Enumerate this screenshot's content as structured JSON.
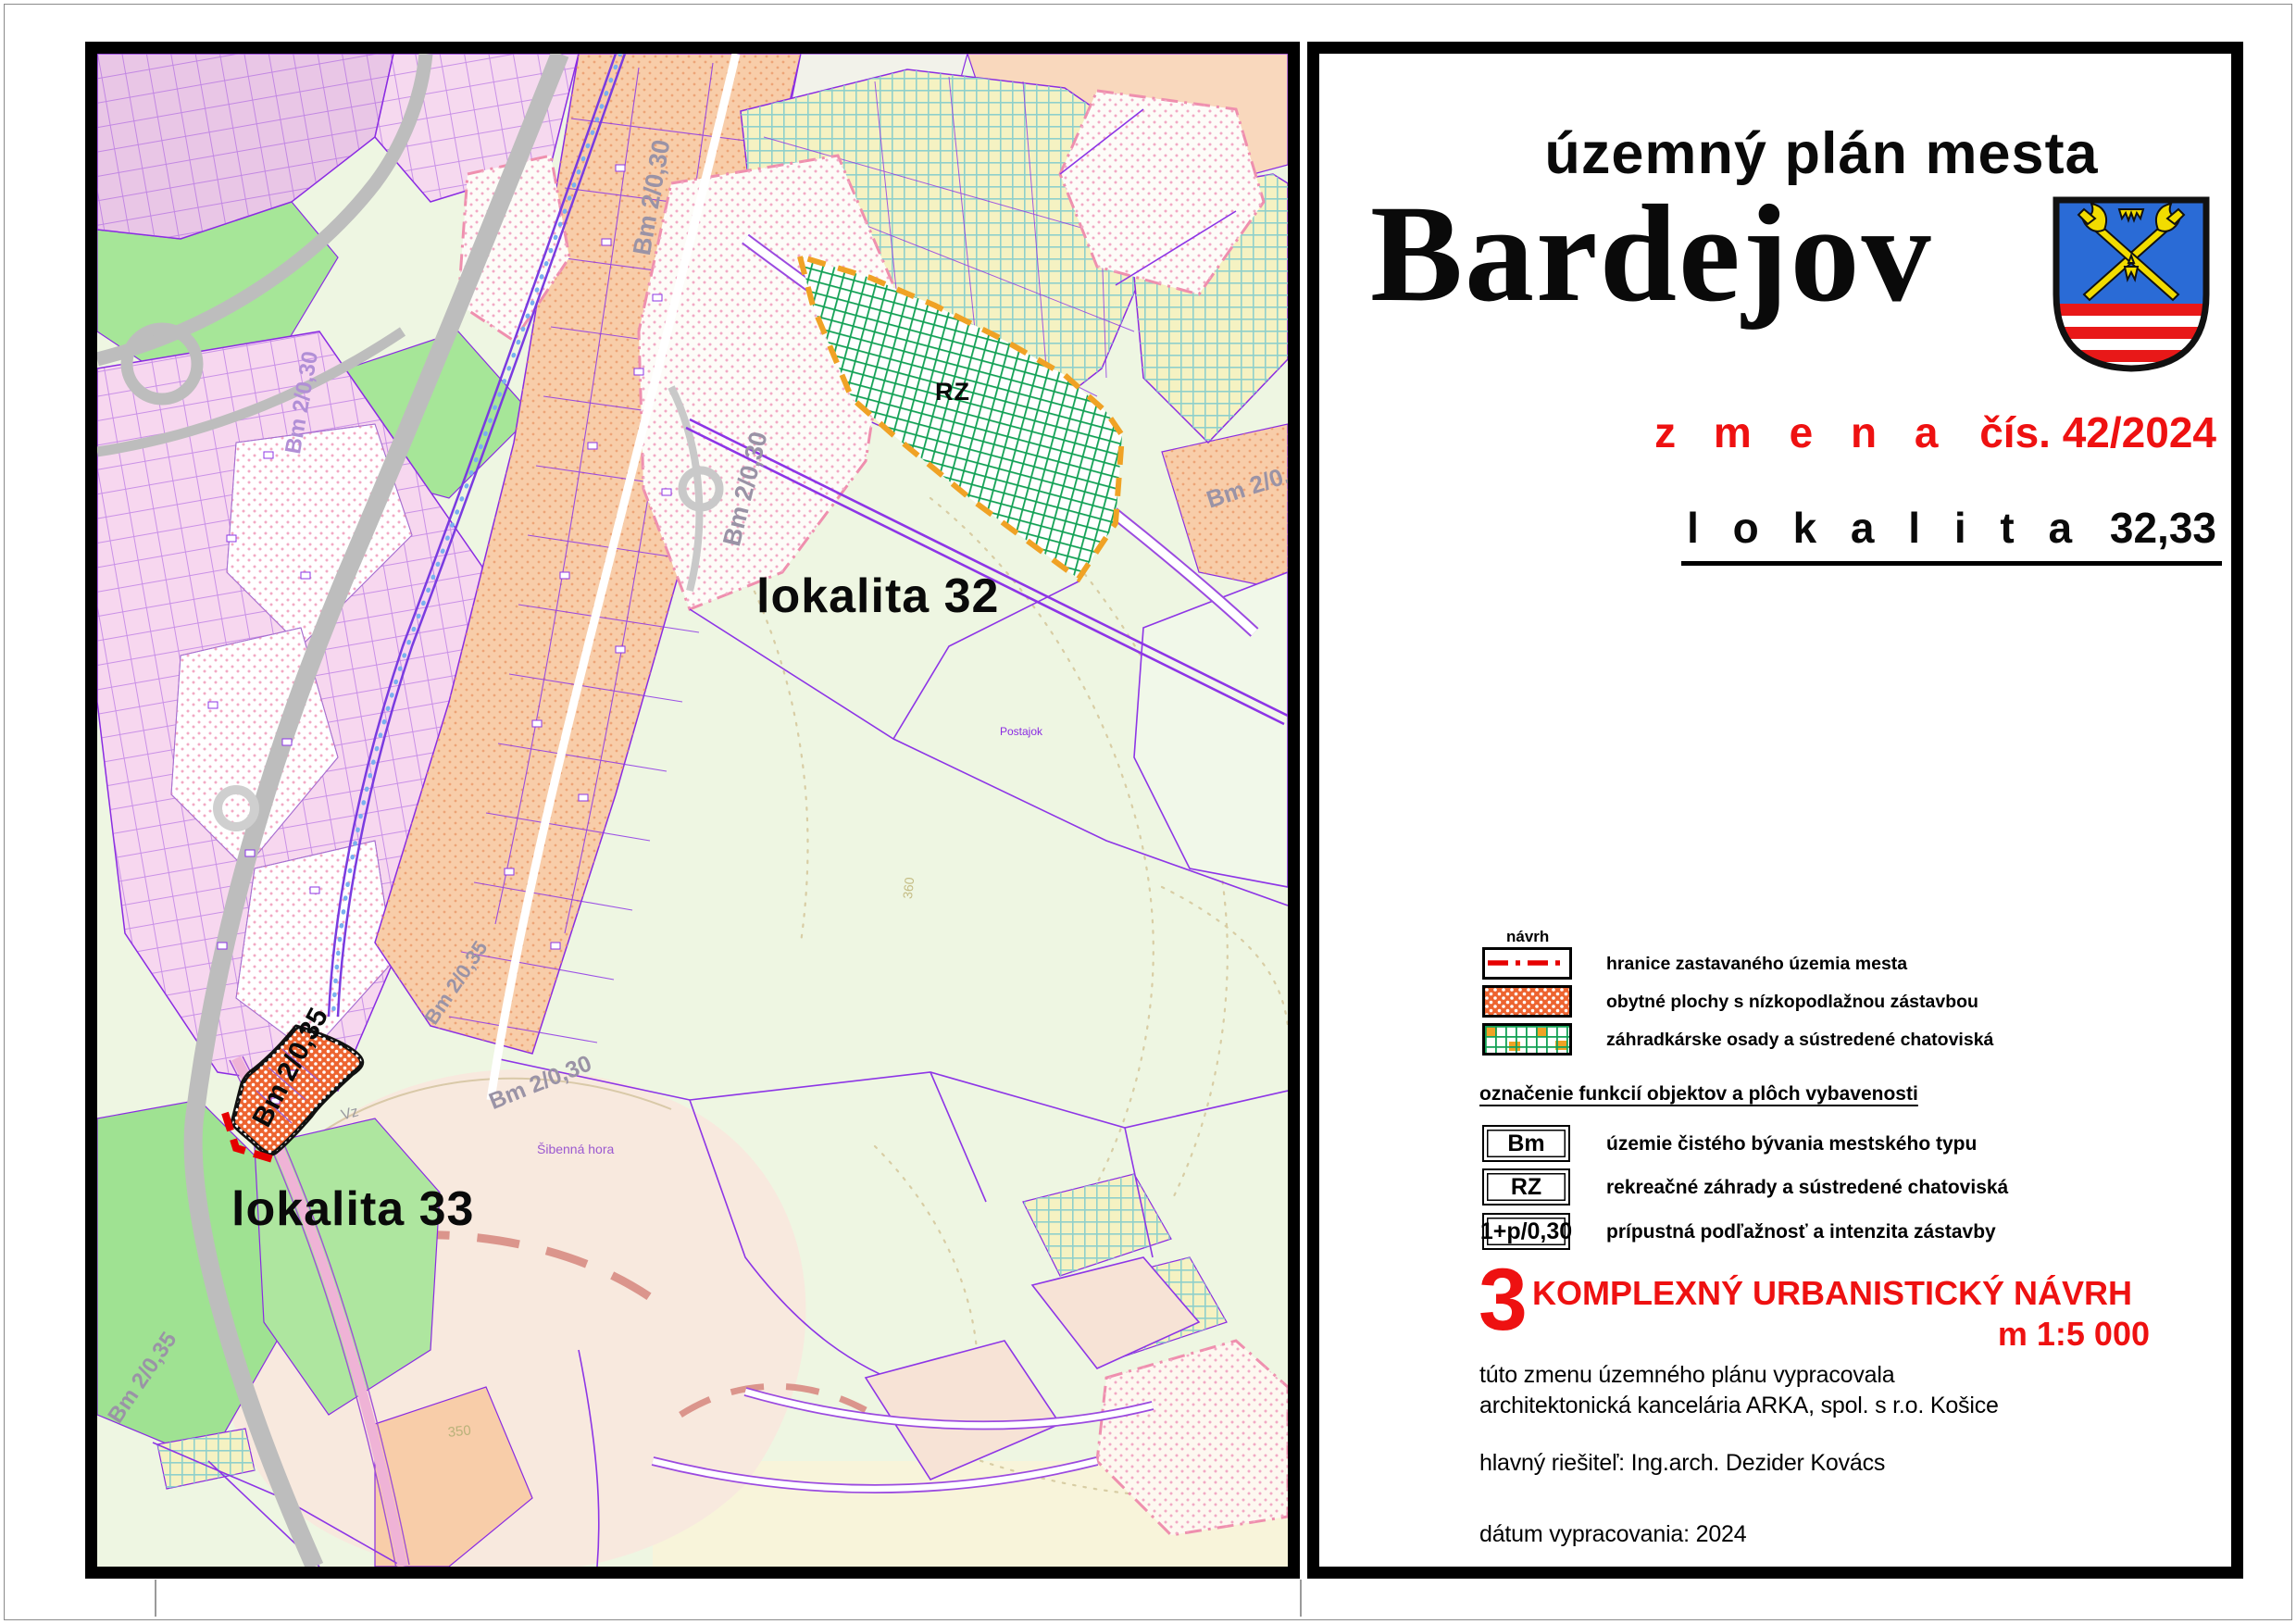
{
  "map": {
    "labels": {
      "lokalita32": "lokalita 32",
      "lokalita33": "lokalita 33",
      "rz": "RZ",
      "parcel": "Bm 2/0,35",
      "bm_g1": "Bm 2/0,30",
      "bm_g2": "Bm 2/0,30",
      "bm_g3": "Bm 2/0,30",
      "bm_g4": "Bm 2/0,30",
      "bm_g5": "Bm 2/0,35",
      "bm_g6": "Bm 2/0,30",
      "bm_g7": "Bm 2/0,35",
      "postajok": "Postajok",
      "sibenna_hora": "Šibenná hora",
      "contour_350": "350",
      "contour_360": "360",
      "vz": "Vz"
    }
  },
  "title_block": {
    "suptitle": "územný plán mesta",
    "city": "Bardejov",
    "zmena_label": "z m e n a",
    "zmena_number": "čís. 42/2024",
    "lokalita_label": "l o k a l i t a",
    "lokalita_number": "32,33"
  },
  "legend": {
    "navrh": "návrh",
    "items": [
      {
        "label": "hranice zastavaného územia mesta"
      },
      {
        "label": "obytné plochy s nízkopodlažnou zástavbou"
      },
      {
        "label": "záhradkárske osady a sústredené chatoviská"
      }
    ]
  },
  "functions_legend": {
    "heading": "označenie funkcií objektov a plôch vybavenosti",
    "items": [
      {
        "symbol": "Bm",
        "label": "územie čistého bývania mestského typu"
      },
      {
        "symbol": "RZ",
        "label": "rekreačné záhrady a sústredené chatoviská"
      },
      {
        "symbol": "1+p/0,30",
        "label": "prípustná podľažnosť a intenzita zástavby"
      }
    ]
  },
  "section": {
    "number": "3",
    "title": "KOMPLEXNÝ URBANISTICKÝ NÁVRH",
    "scale": "m 1:5 000"
  },
  "credits": {
    "line1": "túto zmenu územného plánu vypracovala",
    "line2": "architektonická kancelária ARKA, spol. s r.o. Košice",
    "resolver": "hlavný riešiteľ: Ing.arch. Dezider Kovács",
    "date": "dátum vypracovania: 2024"
  },
  "colors": {
    "accent_red": "#ee1111",
    "parcel_purple": "#8a2be2",
    "change_orange": "#ed6430",
    "rz_green": "#12a155",
    "legend_orange": "#f0a225"
  }
}
